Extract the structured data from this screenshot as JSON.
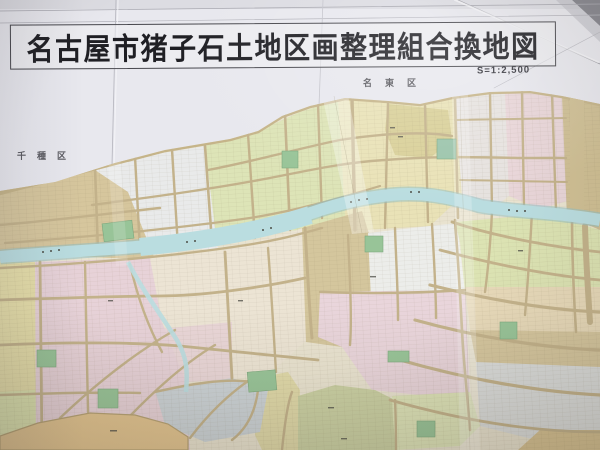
{
  "photo": {
    "title": "名古屋市猪子石土地区画整理組合換地図",
    "scale_label": "S=1:2,500",
    "ward_labels": {
      "top": "名東区",
      "left": "千種区"
    },
    "map": {
      "kind": "land-readjustment replotting map (photograph of folded paper map)",
      "palette": {
        "paper": "#e8e8ee",
        "title_ink": "#1f1f24",
        "road_tan": "#c3b28a",
        "river_blue": "#b9dde0",
        "river_edge": "#93bfc3",
        "park_green": "#97c497",
        "park_teal": "#9ac4ab",
        "parcel_tan": "#d6c69c",
        "parcel_white": "#e9eaea",
        "parcel_yellow_green": "#dde4b6",
        "parcel_pale_yellow": "#e9e2b6",
        "parcel_khaki": "#d9d097",
        "parcel_pink": "#e8d2d8",
        "parcel_lavender": "#e6e2df",
        "parcel_olive": "#cbd1a3",
        "parcel_gray_blue": "#ccd3d7",
        "parcel_gray_white": "#dcdedd",
        "block_orange": "#e3c48e",
        "yellow_strip": "#e7dfa8"
      }
    }
  }
}
